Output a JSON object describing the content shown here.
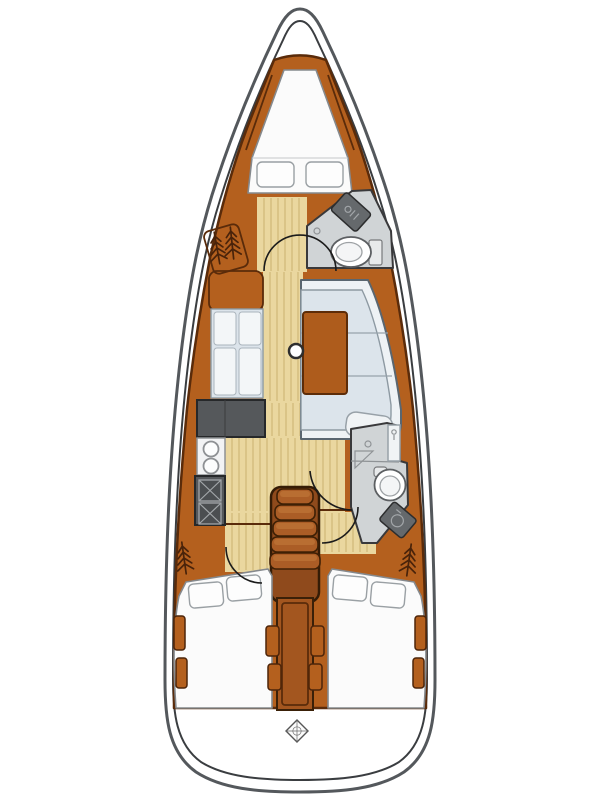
{
  "title": "Sailboat interior deck plan",
  "colors": {
    "bg": "#ffffff",
    "hull_stroke": "#54585c",
    "hull_inner": "#3a3d40",
    "wood": "#b4601e",
    "wood_line": "#5a2b0a",
    "floor": "#ead79f",
    "floor_line": "#c9b06f",
    "cushion": "#dce4eb",
    "cushion_hi": "#f3f6f8",
    "cushion_line": "#8d99a2",
    "mattress": "#fbfbfb",
    "mattress_line": "#85898d",
    "counter": "#55585b",
    "counter_line": "#26282a",
    "appliance": "#4b4e51",
    "appliance_line": "#a2a6a9",
    "head_floor": "#d0d4d6",
    "head_line": "#39393b",
    "step": "#ab5d26",
    "table": "#ae5c1c",
    "arc": "#1b1b1b",
    "tree": "#49230a"
  },
  "parts": {
    "hull": "Hull",
    "v_berth": "Forward V-berth",
    "forward_cabin": "Forward cabin",
    "forward_head": "Forward head with toilet and sink",
    "salon": "Salon with settees and table",
    "galley": "Galley with twin sinks and two-burner stove",
    "mast": "Mast post",
    "companionway": "Companionway steps",
    "aft_head": "Aft head with toilet, shower and sink",
    "aft_cabin_port": "Port aft cabin with double berth",
    "aft_cabin_starboard": "Starboard aft cabin with double berth",
    "hanging_locker": "Hanging locker",
    "transom": "Transom with steering symbol"
  },
  "counts": {
    "companionway_steps": 5,
    "stove_burners": 2,
    "galley_sinks": 2,
    "toilets": 2,
    "vberth_pillows": 2,
    "aft_pillows_per_cabin": 2,
    "hanging_locker_symbols": 4,
    "aft_cabins": 2,
    "salon_settees": 2
  }
}
